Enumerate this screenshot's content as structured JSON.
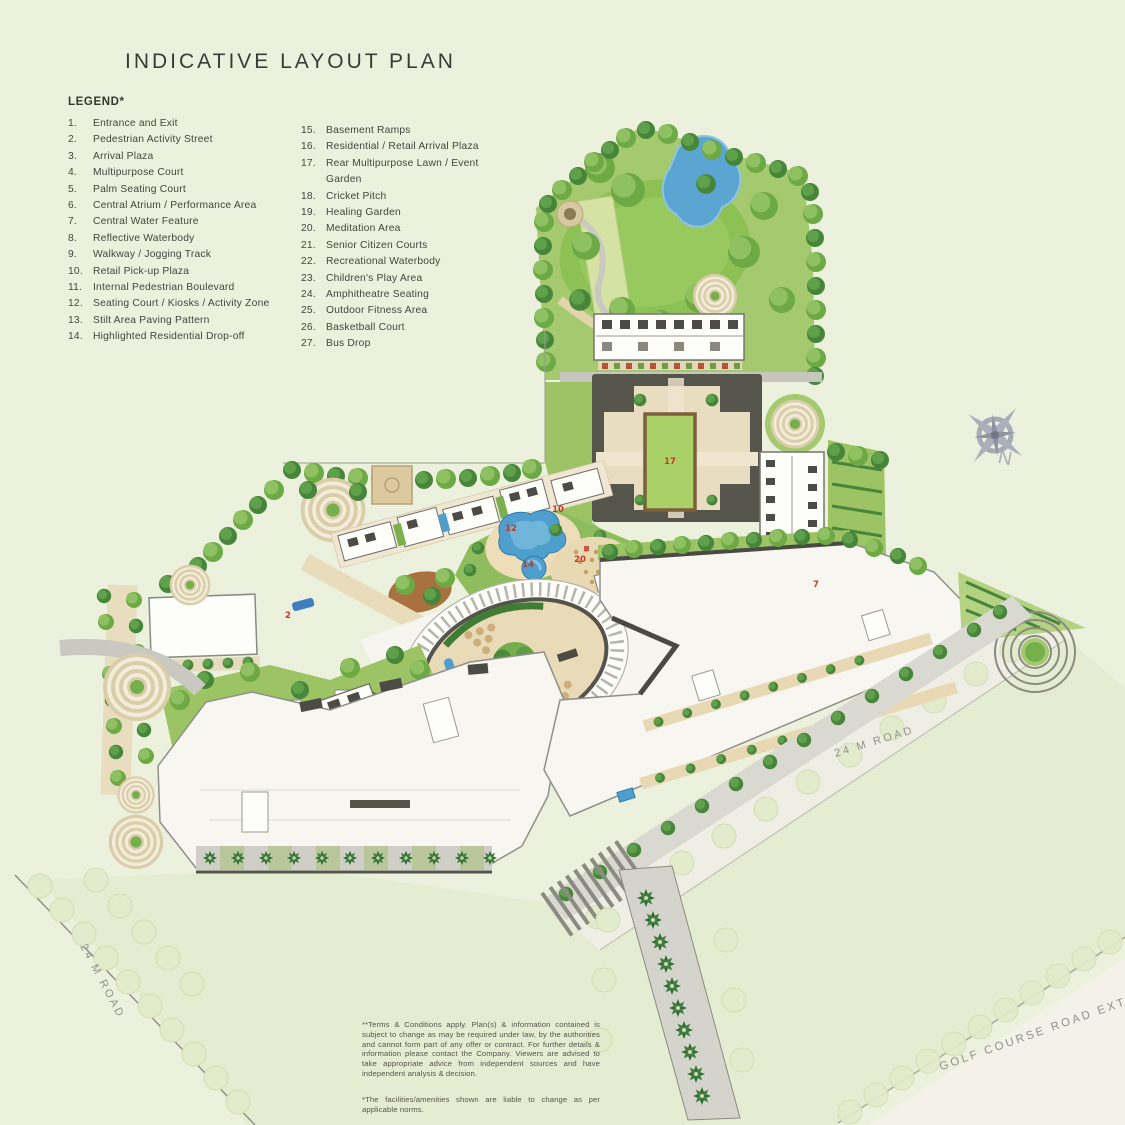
{
  "page": {
    "title": "INDICATIVE LAYOUT PLAN"
  },
  "legend": {
    "heading": "LEGEND*",
    "col1": [
      {
        "n": "1.",
        "label": "Entrance and Exit"
      },
      {
        "n": "2.",
        "label": "Pedestrian Activity Street"
      },
      {
        "n": "3.",
        "label": "Arrival Plaza"
      },
      {
        "n": "4.",
        "label": "Multipurpose Court"
      },
      {
        "n": "5.",
        "label": "Palm Seating Court"
      },
      {
        "n": "6.",
        "label": "Central Atrium / Performance Area"
      },
      {
        "n": "7.",
        "label": "Central Water Feature"
      },
      {
        "n": "8.",
        "label": "Reflective Waterbody"
      },
      {
        "n": "9.",
        "label": "Walkway / Jogging Track"
      },
      {
        "n": "10.",
        "label": "Retail Pick-up Plaza"
      },
      {
        "n": "11.",
        "label": "Internal Pedestrian Boulevard"
      },
      {
        "n": "12.",
        "label": "Seating Court / Kiosks / Activity Zone"
      },
      {
        "n": "13.",
        "label": "Stilt Area Paving Pattern"
      },
      {
        "n": "14.",
        "label": "Highlighted Residential Drop-off"
      }
    ],
    "col2": [
      {
        "n": "15.",
        "label": "Basement Ramps"
      },
      {
        "n": "16.",
        "label": "Residential / Retail Arrival Plaza"
      },
      {
        "n": "17.",
        "label": "Rear Multipurpose Lawn / Event Garden"
      },
      {
        "n": "18.",
        "label": "Cricket Pitch"
      },
      {
        "n": "19.",
        "label": "Healing Garden"
      },
      {
        "n": "20.",
        "label": "Meditation Area"
      },
      {
        "n": "21.",
        "label": "Senior Citizen Courts"
      },
      {
        "n": "22.",
        "label": "Recreational Waterbody"
      },
      {
        "n": "23.",
        "label": "Children's Play Area"
      },
      {
        "n": "24.",
        "label": "Amphitheatre Seating"
      },
      {
        "n": "25.",
        "label": "Outdoor Fitness Area"
      },
      {
        "n": "26.",
        "label": "Basketball Court"
      },
      {
        "n": "27.",
        "label": "Bus Drop"
      }
    ]
  },
  "map": {
    "road_labels": {
      "right": "24 M ROAD",
      "left": "24 M ROAD",
      "golf": "GOLF COURSE ROAD EXTN."
    },
    "compass_label": "N",
    "numbers": [
      {
        "n": "17"
      },
      {
        "n": "12"
      },
      {
        "n": "14"
      },
      {
        "n": "20"
      },
      {
        "n": "10"
      },
      {
        "n": "7"
      },
      {
        "n": "2"
      }
    ],
    "colors": {
      "water": "#4f9fce",
      "lawn": "#8dc153",
      "site_green": "#a4c96f",
      "path_tan": "#e7dbbd",
      "building_white": "#f7f6f1",
      "label_red": "#c43a28"
    }
  },
  "disclaimer": {
    "para1": "**Terms & Conditions apply. Plan(s) & information contained is subject to change as may be required under law, by the authorities and cannot form part of any offer or contract. For further details & information please contact the Company. Viewers are advised to take appropriate advice from independent sources and have independent analysis & decision.",
    "para2": "*The facilities/amenities shown are liable to change as per applicable norms."
  }
}
